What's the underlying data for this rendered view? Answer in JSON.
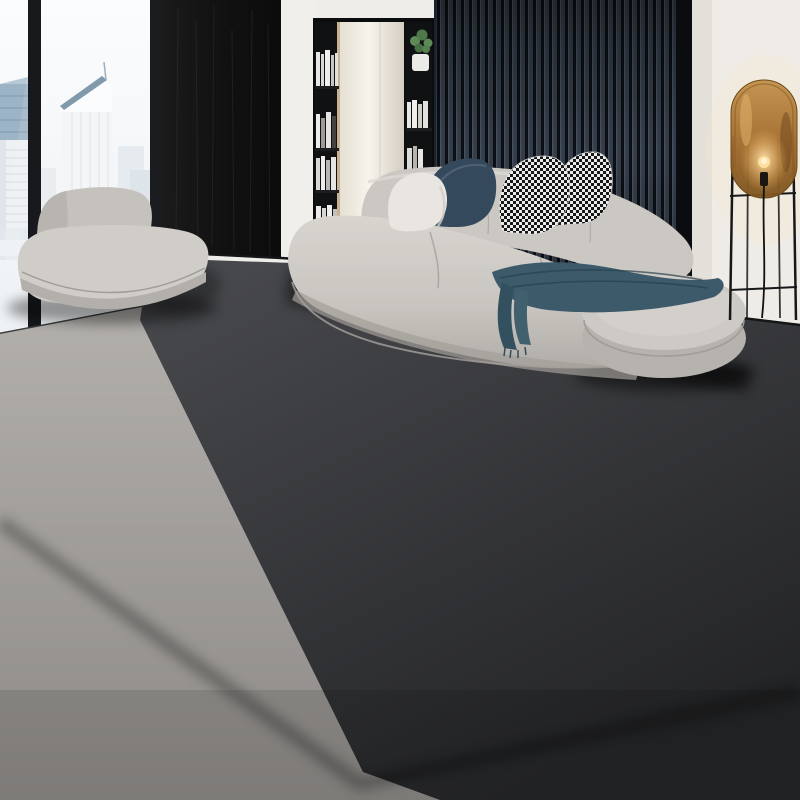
{
  "scene": {
    "type": "product-photograph",
    "subject": "Luxury ivory and gold area rug with Greek key border and black scroll medallion",
    "setting": "Modern high-rise living room with curved grey sofa, city-view window, slatted accent wall and amber glass floor lamp"
  },
  "palette": {
    "sky": "#fafbfc",
    "building": "#dfe7ee",
    "window_frame": "#17191c",
    "stone_wall": "#141414",
    "wall_white": "#f0eeea",
    "slat_light": "#37414e",
    "slat_dark": "#0c0f15",
    "mirror": "#efebe2",
    "floor_light": "#a6a3a0",
    "floor_dark": "#3a3b3e",
    "sofa": "#cbc7c2",
    "settee": "#d0ccc7",
    "pillow_white": "#e9e6e2",
    "pillow_navy": "#35495c",
    "houndstooth_black": "#16181a",
    "throw": "#3c5a6a",
    "lamp_amber": "#b0813e",
    "lamp_glow": "#ffdf9e",
    "rug_tan": "#c7b492",
    "rug_tile": "#d4c3a4",
    "rug_gold": "#d9b153",
    "rug_gold_deep": "#8f681f",
    "meander": "#5f5848",
    "rug_field": "#f2e9d8",
    "vein_gold": "#c49a5f",
    "medallion_black": "#1c1814",
    "rug_outline": "#17130e"
  },
  "objects": {
    "window": "floor-to-ceiling window with skyscraper skyline",
    "stone_wall": "black slate feature wall",
    "bookshelf": "black built-in shelving with books and plant",
    "mirror": "tall mirror panel",
    "slat_panel": "dark wood slat accent wall",
    "sofa": "curved modular sofa",
    "settee": "small curved settee",
    "ottoman": "rounded ottoman end of sofa",
    "pillows": [
      "white pillow",
      "navy pillow",
      "houndstooth pillow",
      "houndstooth pillow small"
    ],
    "throw": "teal-blue throw blanket",
    "lamp": "amber glass capsule floor lamp with black cage stand",
    "rug": "marble-look rug with gold tile border, Greek key band and black medallion",
    "floor": "two-tone grey concrete floor"
  }
}
